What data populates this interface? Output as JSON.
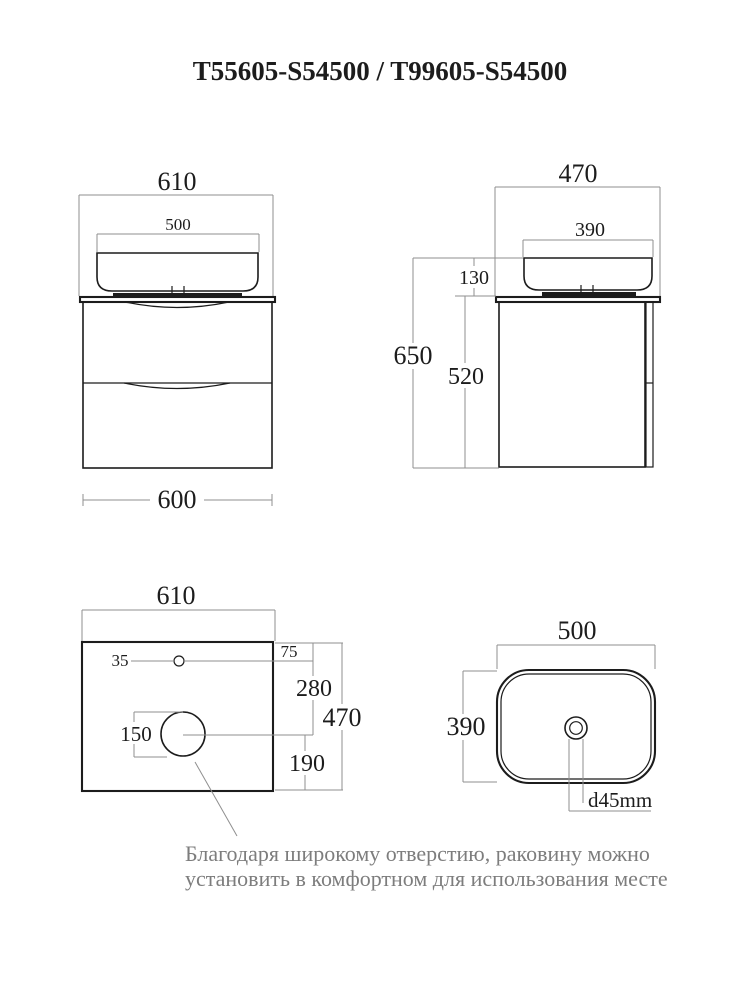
{
  "title": "T55605-S54500 / T99605-S54500",
  "front_view": {
    "overall_width": "610",
    "sink_width": "500",
    "cabinet_width": "600"
  },
  "side_view": {
    "overall_depth": "470",
    "sink_depth": "390",
    "sink_height": "130",
    "total_height": "650",
    "cabinet_height": "520"
  },
  "countertop_view": {
    "width": "610",
    "faucet_hole_diameter": "35",
    "faucet_hole_offset": "75",
    "hole_spacing": "280",
    "drain_hole_diameter": "150",
    "depth": "470",
    "drain_offset": "190"
  },
  "sink_view": {
    "width": "500",
    "depth": "390",
    "drain_diameter": "d45mm"
  },
  "annotation": {
    "line1": "Благодаря широкому отверстию, раковину можно",
    "line2": "установить в комфортном для использования месте"
  },
  "colors": {
    "outline": "#1c1c1c",
    "dimension_line": "#8f8f8f",
    "annotation_text": "#7d7d7d"
  }
}
